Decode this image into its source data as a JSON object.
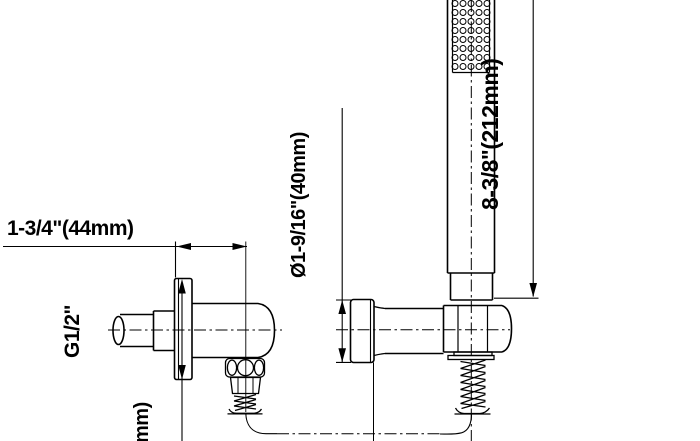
{
  "drawing": {
    "title": "shower-outlet-and-handheld-wand-dimension-drawing",
    "colors": {
      "line": "#000000",
      "background": "#ffffff"
    },
    "labels": {
      "top_width": "1-3/4\"(44mm)",
      "inlet_thread": "G1/2\"",
      "holder_diameter": "Ø1-9/16\"(40mm)",
      "wand_length": "8-3/8\"(212mm)",
      "flange_dim_partial": "mm)"
    }
  }
}
